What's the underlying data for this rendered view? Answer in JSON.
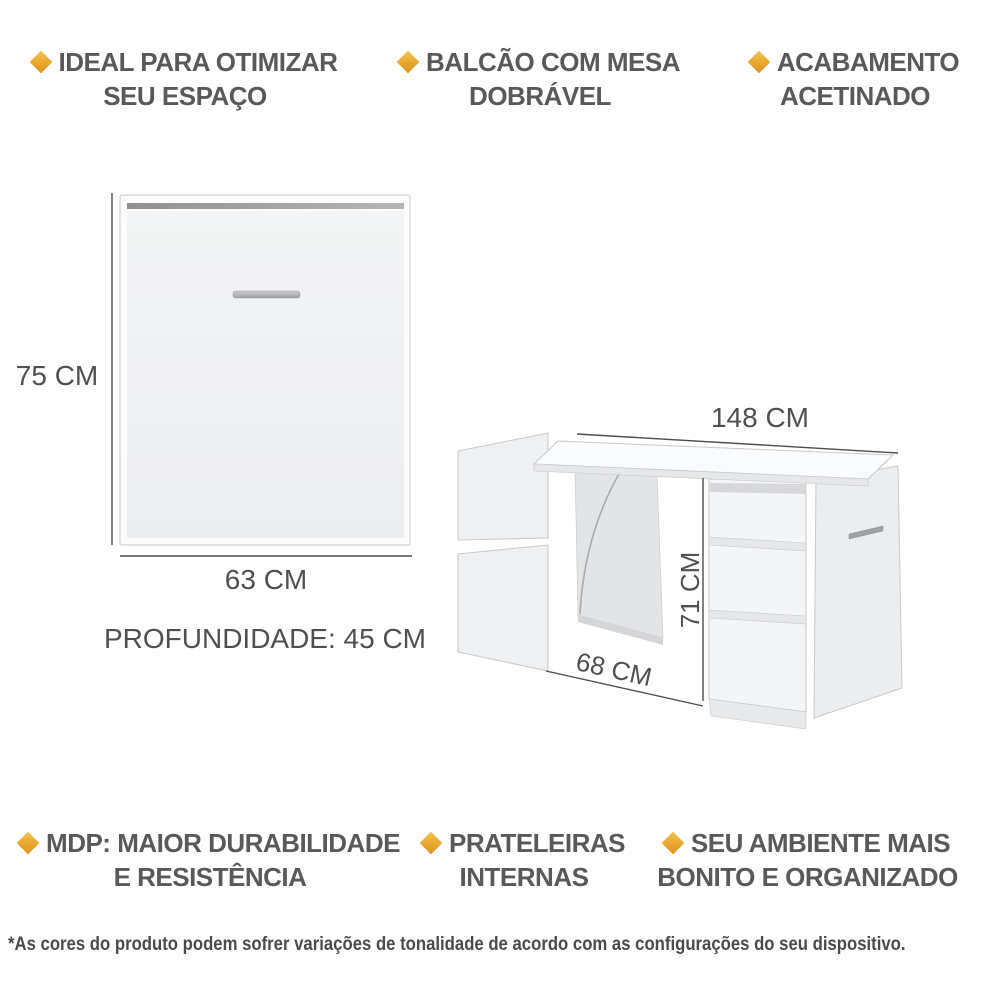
{
  "accent_color": "#E8A62E",
  "text_color": "#595959",
  "line_color": "#4d4d4d",
  "features_top": [
    {
      "line1": "IDEAL PARA OTIMIZAR",
      "line2": "SEU ESPAÇO"
    },
    {
      "line1": "BALCÃO COM MESA",
      "line2": "DOBRÁVEL"
    },
    {
      "line1": "ACABAMENTO",
      "line2": "ACETINADO"
    }
  ],
  "features_bottom": [
    {
      "line1": "MDP: MAIOR DURABILIDADE",
      "line2": "E RESISTÊNCIA"
    },
    {
      "line1": "PRATELEIRAS",
      "line2": "INTERNAS"
    },
    {
      "line1": "SEU AMBIENTE MAIS",
      "line2": "BONITO E ORGANIZADO"
    }
  ],
  "dimensions": {
    "closed": {
      "height": "75 CM",
      "width": "63 CM",
      "depth": "PROFUNDIDADE: 45 CM"
    },
    "open": {
      "width": "148 CM",
      "height": "71 CM",
      "table_width": "68 CM"
    }
  },
  "footer": {
    "disclaimer": "*As cores do produto podem sofrer variações de tonalidade de acordo com as configurações do seu dispositivo."
  }
}
